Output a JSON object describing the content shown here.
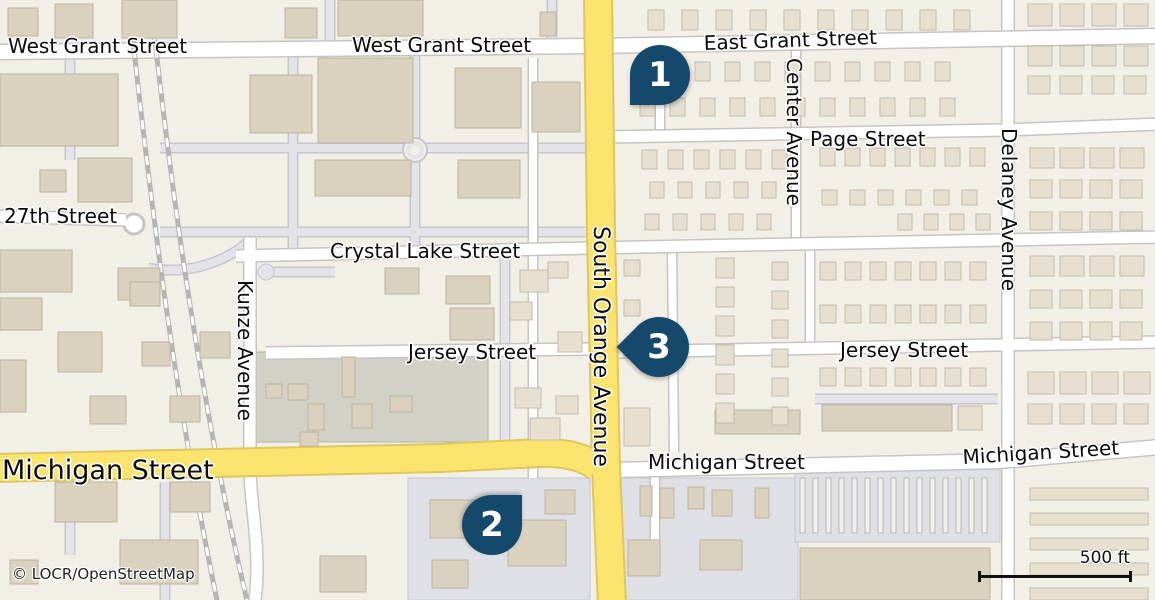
{
  "map": {
    "attribution": "© LOCR/OpenStreetMap",
    "scale_bar": {
      "label": "500 ft"
    },
    "markers": [
      {
        "label": "1"
      },
      {
        "label": "2"
      },
      {
        "label": "3"
      }
    ],
    "street_labels": {
      "west_grant_left": "West Grant Street",
      "west_grant_center": "West Grant Street",
      "east_grant": "East Grant Street",
      "page": "Page Street",
      "center_ave": "Center Avenue",
      "delaney_ave": "Delaney Avenue",
      "twenty_seventh": "27th Street",
      "crystal_lake": "Crystal Lake Street",
      "kunze_ave": "Kunze Avenue",
      "jersey_west": "Jersey Street",
      "jersey_east": "Jersey Street",
      "south_orange": "South Orange Avenue",
      "michigan_west": "Michigan Street",
      "michigan_center": "Michigan Street",
      "michigan_east": "Michigan Street"
    },
    "colors": {
      "background": "#f2efe7",
      "building": "#dbd1bf",
      "building_light": "#e7dfcf",
      "road_fill": "#ffffff",
      "road_casing": "#c6c5c2",
      "primary_road": "#fbe46d",
      "primary_casing": "#ddc75f",
      "service_road": "#e3e3e9",
      "industrial_lot": "#d1d2c5",
      "parking_lot": "#dfe0e6",
      "railway": "#b5b5b5",
      "marker": "#15496b",
      "label_text": "#0b0b0b",
      "label_halo": "#ffffff"
    }
  }
}
